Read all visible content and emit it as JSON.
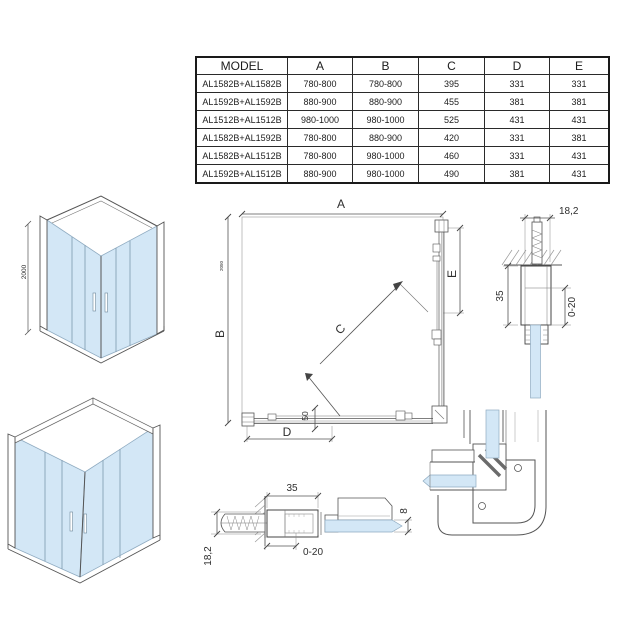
{
  "colors": {
    "glass": "#d3e7f6",
    "glass_edge": "#8fabc1",
    "line": "#4a4a4a",
    "table_border": "#1a1a1a",
    "background": "#ffffff"
  },
  "table": {
    "headers": [
      "MODEL",
      "A",
      "B",
      "C",
      "D",
      "E"
    ],
    "rows": [
      [
        "AL1582B+AL1582B",
        "780-800",
        "780-800",
        "395",
        "331",
        "331"
      ],
      [
        "AL1592B+AL1592B",
        "880-900",
        "880-900",
        "455",
        "381",
        "381"
      ],
      [
        "AL1512B+AL1512B",
        "980-1000",
        "980-1000",
        "525",
        "431",
        "431"
      ],
      [
        "AL1582B+AL1592B",
        "780-800",
        "880-900",
        "420",
        "331",
        "381"
      ],
      [
        "AL1582B+AL1512B",
        "780-800",
        "980-1000",
        "460",
        "331",
        "431"
      ],
      [
        "AL1592B+AL1512B",
        "880-900",
        "980-1000",
        "490",
        "381",
        "431"
      ]
    ]
  },
  "iso_front_view": {
    "height_dim": "2000"
  },
  "plan_view": {
    "dim_a": "A",
    "dim_b": "B",
    "dim_b_small": "2050",
    "dim_c": "C",
    "dim_d": "D",
    "dim_e": "E",
    "dim_50": "50"
  },
  "wall_profile_detail_top": {
    "dim_width": "18,2",
    "dim_depth": "35",
    "dim_adjust": "0-20"
  },
  "wall_profile_detail_bottom": {
    "dim_depth": "35",
    "dim_adjust": "0-20",
    "dim_width": "18,2",
    "dim_glass": "8"
  }
}
